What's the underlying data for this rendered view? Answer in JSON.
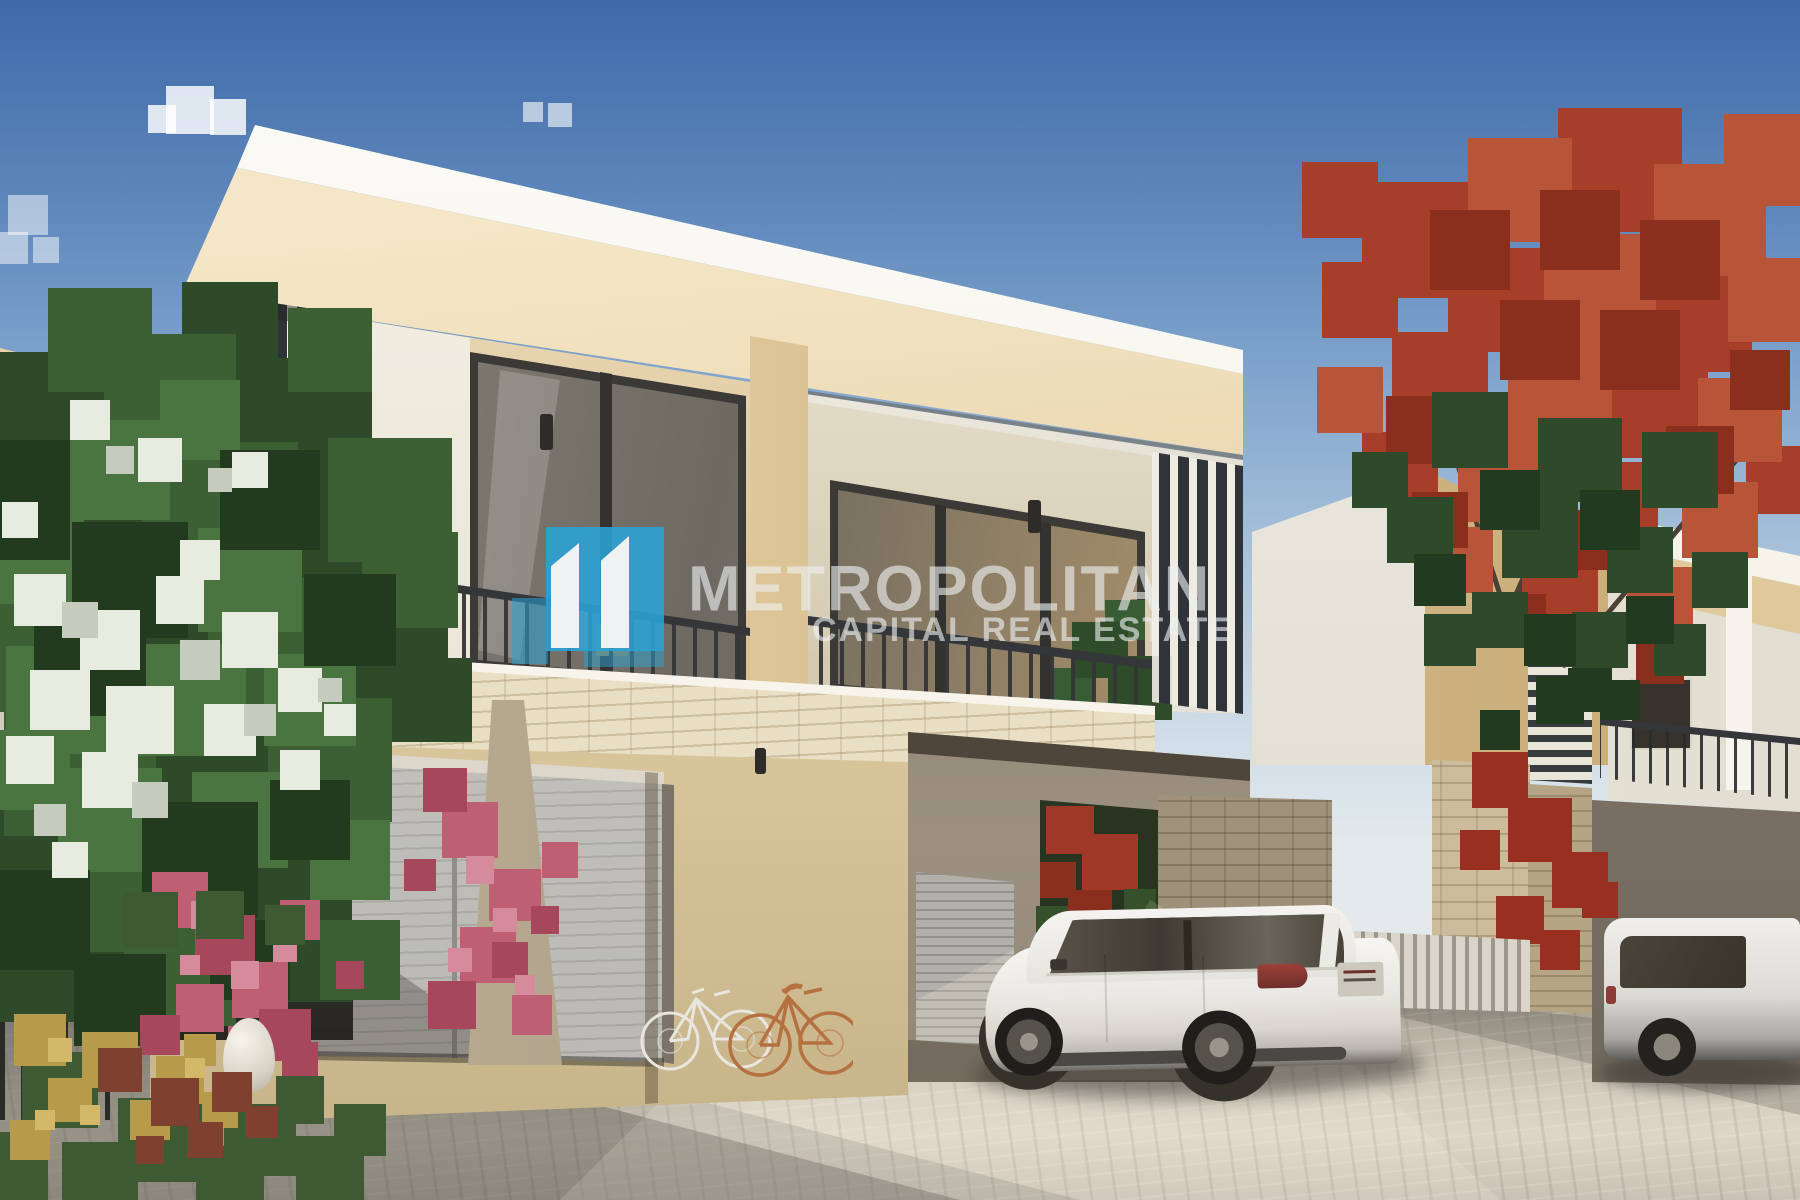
{
  "watermark": {
    "brand": "METROPOLITAN",
    "tagline": "CAPITAL REAL ESTATE",
    "logo_color": "#2aa3d6",
    "text_color": "#eef1f2"
  },
  "scene": {
    "type": "real-estate-rendering",
    "subject": "modern two-storey beige-and-white townhouses with dark louvers, balconies, garage, white SUV parked in driveway, flowering trees",
    "palette": {
      "sky_top": "#3f6aa8",
      "sky_horizon": "#e2e9ec",
      "facade_white": "#faf9f3",
      "facade_beige": "#e7d3ab",
      "louver_dark": "#32363c",
      "stone_cream": "#e9dfc4",
      "pavement": "#cfc8ba",
      "car_white": "#ebe9e4",
      "flower_pink": "#c06070",
      "flower_red": "#a63e2a",
      "flower_white": "#e8ebe0",
      "foliage_green": "#3c5f33"
    }
  }
}
